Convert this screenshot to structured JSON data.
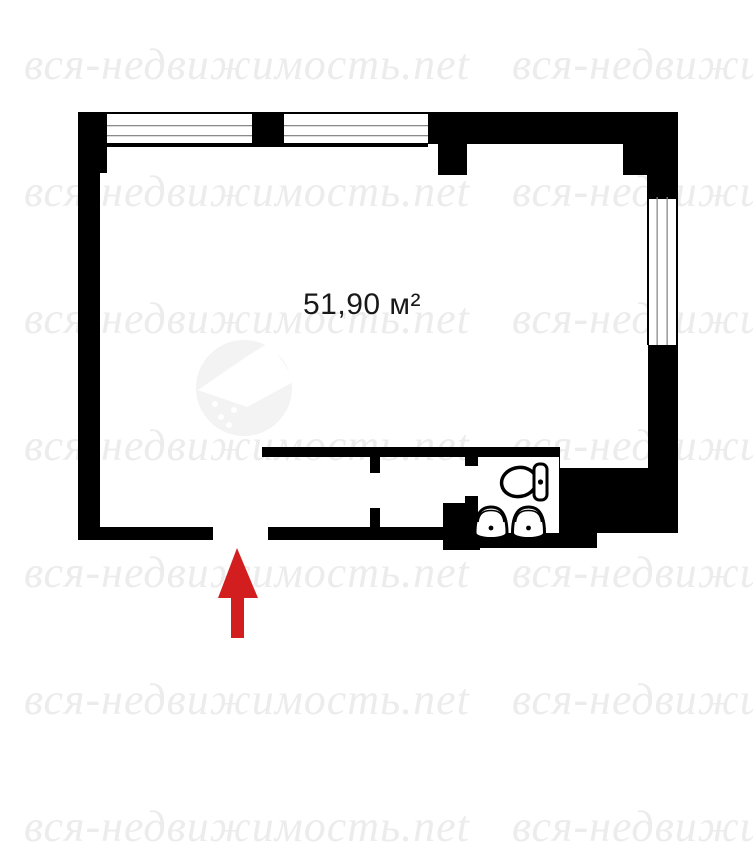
{
  "watermark": {
    "text": "вся-недвижимость.net",
    "color": "#ececec"
  },
  "logo": {
    "circle_color": "#f3f3f3"
  },
  "floor_plan": {
    "area_label": "51,90 м²",
    "wall_color": "#000000",
    "window_line_color": "#8a8a8a",
    "window_top_count": 2,
    "window_right_count": 1,
    "fixtures": {
      "toilet": "toilet-icon",
      "sink": "sink-icon",
      "sink_count": 2
    }
  },
  "entrance_arrow": {
    "color": "#d21e1e",
    "direction": "up"
  }
}
